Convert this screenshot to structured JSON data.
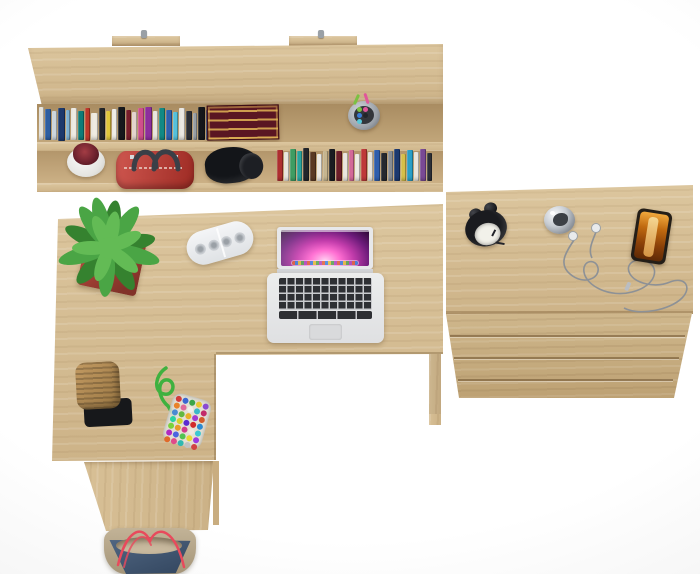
{
  "scene": {
    "label": "Top-down product photo of a light oak home office set: wall shelf with books, L-shaped desk with laptop, and drawer chest",
    "background": "#ececec",
    "wood_base": "#d5be96",
    "wood_light": "#e2d0ab",
    "wood_dark": "#c3a87d"
  },
  "wall_shelf": {
    "label": "wall shelf with books and accessories",
    "mount_pin_color": "#9aa0a6",
    "top_books": [
      {
        "c": "#e9e6de",
        "w": 5,
        "h": 33,
        "m": 2
      },
      {
        "c": "#2e5fa3",
        "w": 6,
        "h": 31,
        "m": 4
      },
      {
        "c": "#cfd8e0",
        "w": 5,
        "h": 29,
        "m": 6
      },
      {
        "c": "#1d3a6e",
        "w": 7,
        "h": 33,
        "m": 3
      },
      {
        "c": "#7fb3d6",
        "w": 5,
        "h": 30,
        "m": 5
      },
      {
        "c": "#efece4",
        "w": 6,
        "h": 32,
        "m": 3
      },
      {
        "c": "#0f7d7a",
        "w": 6,
        "h": 29,
        "m": 6
      },
      {
        "c": "#c0392b",
        "w": 5,
        "h": 33,
        "m": 3
      },
      {
        "c": "#f0ece2",
        "w": 7,
        "h": 27,
        "m": 8
      },
      {
        "c": "#23262b",
        "w": 6,
        "h": 32,
        "m": 3
      },
      {
        "c": "#e3c93c",
        "w": 5,
        "h": 29,
        "m": 6
      },
      {
        "c": "#f2efe9",
        "w": 5,
        "h": 31,
        "m": 4
      },
      {
        "c": "#17191d",
        "w": 7,
        "h": 33,
        "m": 2
      },
      {
        "c": "#7a1f2b",
        "w": 6,
        "h": 30,
        "m": 5
      },
      {
        "c": "#e7d7d0",
        "w": 5,
        "h": 28,
        "m": 7
      },
      {
        "c": "#d14f8e",
        "w": 6,
        "h": 32,
        "m": 3
      },
      {
        "c": "#8e2f9e",
        "w": 7,
        "h": 33,
        "m": 2
      },
      {
        "c": "#ece9e2",
        "w": 5,
        "h": 29,
        "m": 6
      },
      {
        "c": "#128a86",
        "w": 6,
        "h": 32,
        "m": 3
      },
      {
        "c": "#2f61b0",
        "w": 6,
        "h": 30,
        "m": 5
      },
      {
        "c": "#56c3de",
        "w": 5,
        "h": 28,
        "m": 7
      },
      {
        "c": "#ece9e4",
        "w": 6,
        "h": 32,
        "m": 3
      },
      {
        "c": "#2b2e35",
        "w": 6,
        "h": 29,
        "m": 6
      },
      {
        "c": "#9aa1a8",
        "w": 5,
        "h": 27,
        "m": 8
      },
      {
        "c": "#15171b",
        "w": 7,
        "h": 33,
        "m": 2
      },
      {
        "c": "#223d7a",
        "w": 6,
        "h": 30,
        "m": 5
      },
      {
        "c": "#6f42a8",
        "w": 6,
        "h": 32,
        "m": 3
      }
    ],
    "ornate_book": {
      "cover": "#5a1622",
      "gilt": "#e2b556"
    },
    "pencil_cup": {
      "cup": "#9fa4aa",
      "inner": "#33363b",
      "pens": [
        "#7cc043",
        "#e0579a",
        "#3a7bd5",
        "#23252a",
        "#58c8d8"
      ]
    },
    "flower_pot": {
      "pot": "#f2f1ee",
      "plant": "#6e222e",
      "accent": "#a33c44"
    },
    "handbag": {
      "body": "#c5362d",
      "handles": "#3a3f47",
      "hardware": "#d9dadc"
    },
    "headphones": {
      "body": "#131519",
      "cup": "#1d1f24"
    },
    "lower_books": [
      {
        "c": "#b03030",
        "w": 6,
        "h": 31,
        "m": 3
      },
      {
        "c": "#ece8e0",
        "w": 5,
        "h": 29,
        "m": 5
      },
      {
        "c": "#3f9e63",
        "w": 6,
        "h": 32,
        "m": 2
      },
      {
        "c": "#2aa7a0",
        "w": 5,
        "h": 30,
        "m": 4
      },
      {
        "c": "#23262b",
        "w": 6,
        "h": 33,
        "m": 1
      },
      {
        "c": "#5b3a24",
        "w": 6,
        "h": 29,
        "m": 5
      },
      {
        "c": "#efece5",
        "w": 5,
        "h": 27,
        "m": 7
      },
      {
        "c": "#c9b891",
        "w": 5,
        "h": 30,
        "m": 4
      },
      {
        "c": "#1b1d22",
        "w": 6,
        "h": 32,
        "m": 2
      },
      {
        "c": "#6e1f2a",
        "w": 6,
        "h": 30,
        "m": 4
      },
      {
        "c": "#ede9e2",
        "w": 5,
        "h": 28,
        "m": 6
      },
      {
        "c": "#d66a9a",
        "w": 5,
        "h": 31,
        "m": 3
      },
      {
        "c": "#f0ede6",
        "w": 5,
        "h": 27,
        "m": 7
      },
      {
        "c": "#c03a3a",
        "w": 6,
        "h": 32,
        "m": 2
      },
      {
        "c": "#e9e6df",
        "w": 5,
        "h": 29,
        "m": 5
      },
      {
        "c": "#2f5fae",
        "w": 6,
        "h": 31,
        "m": 3
      },
      {
        "c": "#26292f",
        "w": 6,
        "h": 28,
        "m": 6
      },
      {
        "c": "#8a8f96",
        "w": 5,
        "h": 30,
        "m": 4
      },
      {
        "c": "#1d3a70",
        "w": 6,
        "h": 32,
        "m": 2
      },
      {
        "c": "#d8c24a",
        "w": 5,
        "h": 27,
        "m": 7
      },
      {
        "c": "#2aa0c8",
        "w": 6,
        "h": 31,
        "m": 3
      },
      {
        "c": "#ece9e2",
        "w": 5,
        "h": 29,
        "m": 5
      },
      {
        "c": "#7a4a96",
        "w": 6,
        "h": 32,
        "m": 2
      },
      {
        "c": "#2d3038",
        "w": 5,
        "h": 28,
        "m": 6
      }
    ]
  },
  "desk": {
    "label": "L-shaped oak desk",
    "plant": {
      "pot": "#ad4337",
      "leaf1": "#4aa545",
      "leaf2": "#63bb55",
      "leaf3": "#35822f"
    },
    "power_strip": {
      "body": "#eef0f2",
      "socket": "#c2c6ca"
    },
    "laptop": {
      "body": "#e7e8ea",
      "screen_colors": [
        "#ffd2f2",
        "#ff6ed2",
        "#c23cab",
        "#6c1b7a",
        "#27082f"
      ],
      "key": "#2e2f33",
      "key_gap": "#c9cacd",
      "trackpad": "#d9dadc"
    },
    "basket": {
      "weave": "#b5905a",
      "mat": "#17181b"
    },
    "gumball_pouch": {
      "rope": "#3fb13f",
      "pouch": "#e8e8e2",
      "dots": [
        "#d23b3b",
        "#3b66d2",
        "#3ba54a",
        "#e8c832",
        "#8a4ad2",
        "#e8832a",
        "#e06a9a",
        "#f0efe8",
        "#3ab8c8",
        "#c22b6a",
        "#4a8ad2",
        "#62b842",
        "#e8b02a",
        "#a23ad2",
        "#d25b2b",
        "#2bd2a0",
        "#d2d22b",
        "#5b2bd2",
        "#d22b2b",
        "#2b8ad2",
        "#7ad23b",
        "#e89a2a",
        "#d23b8a",
        "#efe8e0",
        "#3bc8d2",
        "#b02ac2",
        "#4a66e0",
        "#52c252",
        "#e8d832",
        "#9a3ae0",
        "#e06a2a",
        "#e04a8a",
        "#30b8b0",
        "#c2c2c2",
        "#d24242"
      ]
    },
    "tote_bag": {
      "canvas": "#b3a489",
      "denim": "#3f5878",
      "lining": "#c8b99e",
      "strap": "#e84a5c"
    }
  },
  "chest": {
    "label": "oak drawer chest",
    "drawer_count": 3,
    "alarm_clock": {
      "body": "#1a1b1f",
      "face": "#f2f1ea",
      "hands": "#23242a"
    },
    "bell_clock": {
      "metal": "#c7ccd2",
      "center": "#3c4046"
    },
    "earbuds": {
      "cable": "#8d9196",
      "bud": "#e8eaec"
    },
    "phone": {
      "frame": "#241e17",
      "screen": "#c06a10",
      "glow": "#f6d488"
    }
  }
}
